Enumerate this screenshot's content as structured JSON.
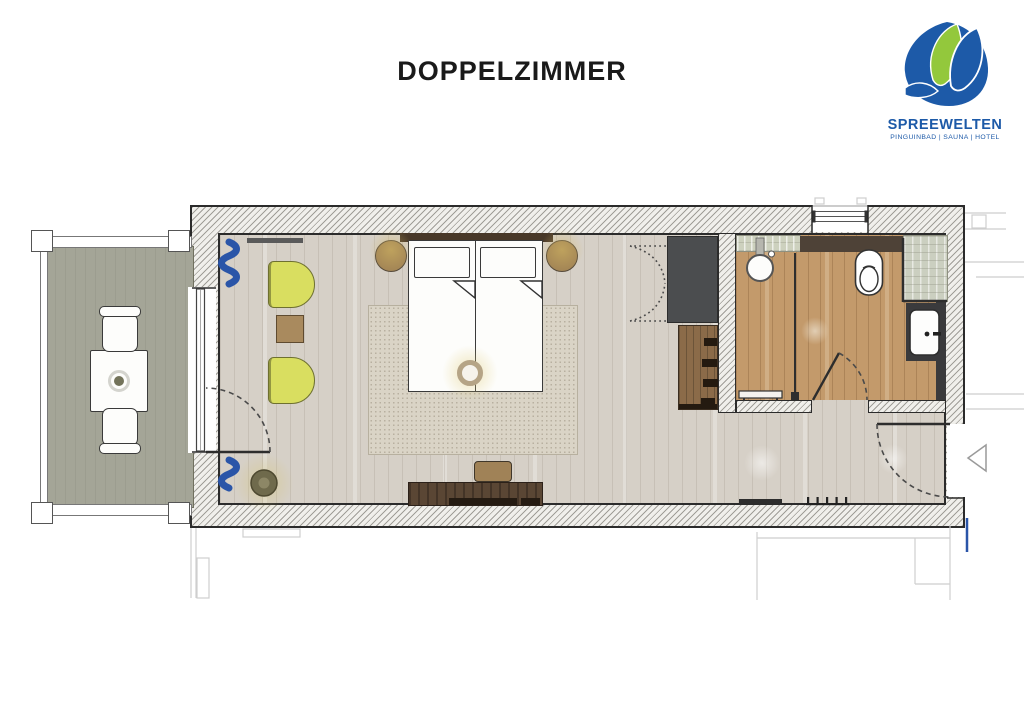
{
  "page": {
    "background": "#ffffff"
  },
  "header": {
    "title": "DOPPELZIMMER"
  },
  "logo": {
    "brand": "SPREEWELTEN",
    "tagline": "PINGUINBAD | SAUNA | HOTEL",
    "brand_blue": "#1d5aa8",
    "brand_green": "#93c83c"
  },
  "plan": {
    "colors": {
      "wall_edge": "#2b2b2b",
      "room_floor": "#d6d0c7",
      "bathroom_floor": "#c39a6b",
      "balcony_floor": "#a4a597",
      "rug": "#dad4c6",
      "lounge_chair": "#d9de60",
      "wood_furniture": "#a3845a",
      "desk": "#53402f",
      "wardrobe": "#4b4d4e",
      "curtain_blue": "#2a55a8",
      "tiles": "#cbcfc0"
    },
    "rooms": [
      "balcony",
      "bedroom",
      "bathroom",
      "entry"
    ],
    "fixtures": [
      "balcony-table",
      "balcony-chair-top",
      "balcony-chair-bottom",
      "balcony-railing",
      "balcony-door",
      "curtains",
      "curtain-rod",
      "lounge-chair-top",
      "lounge-chair-bottom",
      "side-table",
      "floor-lamp",
      "double-bed",
      "pillows",
      "blanket-folds",
      "headboard",
      "nightstand-left",
      "nightstand-right",
      "foot-ring-lamp",
      "rug",
      "desk",
      "stool",
      "wardrobe",
      "bifold-doors",
      "shelf-unit",
      "window",
      "walk-in-shower",
      "rain-shower-head",
      "shower-partition",
      "shower-bench",
      "toilet",
      "shower-tiles",
      "vanity-counter",
      "washbasin",
      "bathroom-door",
      "entry-door",
      "entrance-arrow",
      "coat-hooks",
      "luggage-bench"
    ]
  }
}
